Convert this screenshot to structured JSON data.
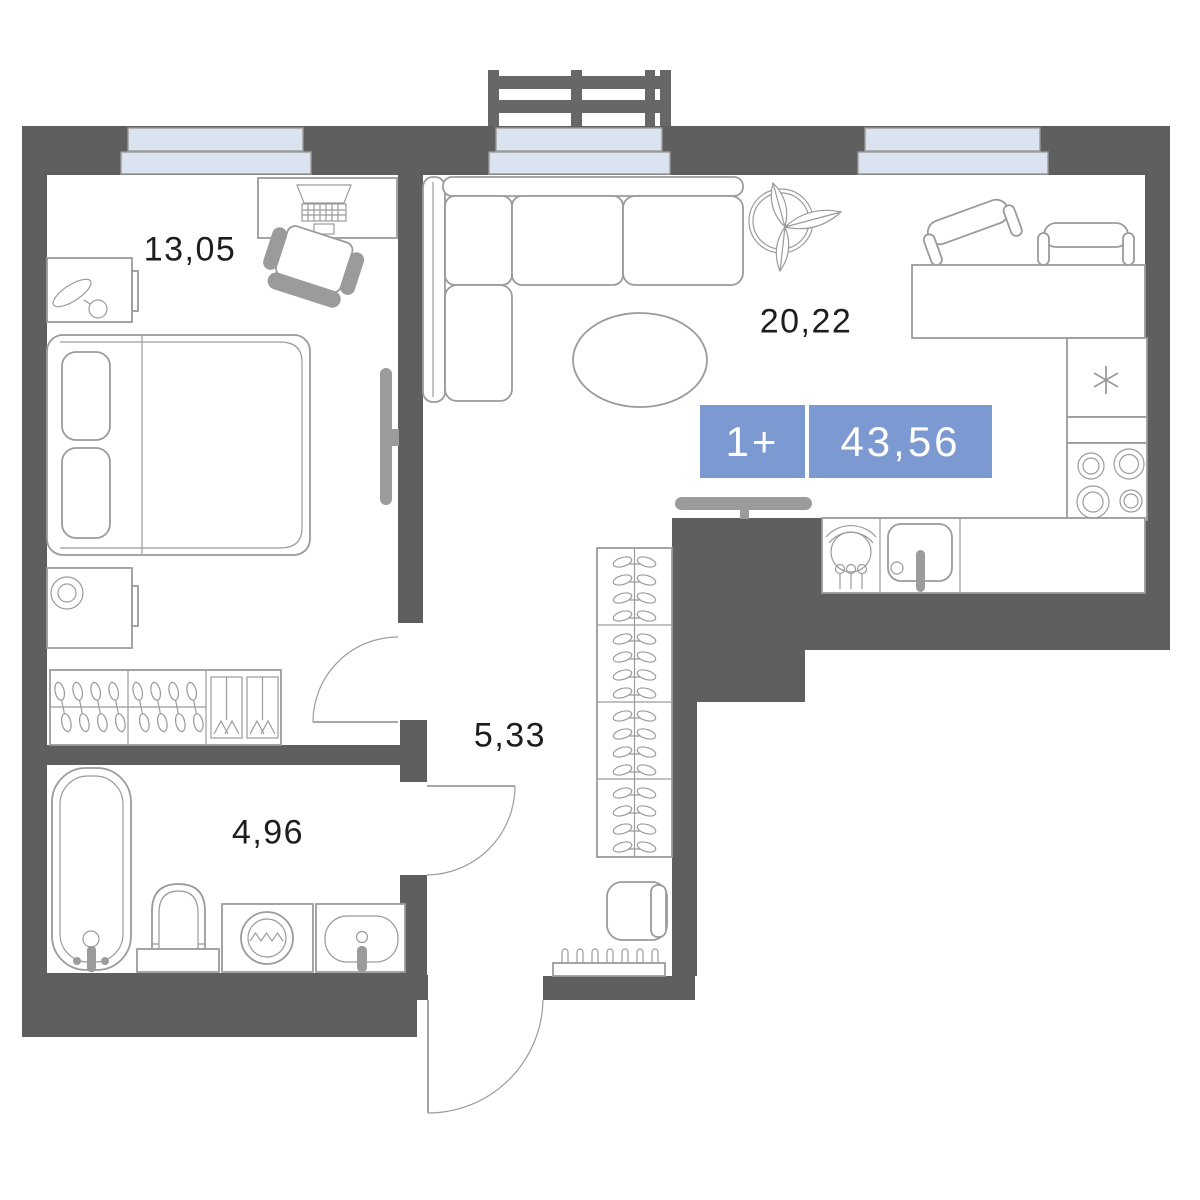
{
  "plan": {
    "type": "apartment-floor-plan",
    "badge": {
      "layout": "1+",
      "total_area": "43,56"
    },
    "rooms": [
      {
        "id": "bedroom",
        "area": "13,05"
      },
      {
        "id": "living-kitchen",
        "area": "20,22"
      },
      {
        "id": "hallway",
        "area": "5,33"
      },
      {
        "id": "bathroom",
        "area": "4,96"
      }
    ],
    "colors": {
      "wall": "#5f5f5f",
      "furniture": "#9b9b9b",
      "window": "#dbe3f0",
      "badge": "#7d99d1",
      "label": "#1d1d1d"
    }
  }
}
